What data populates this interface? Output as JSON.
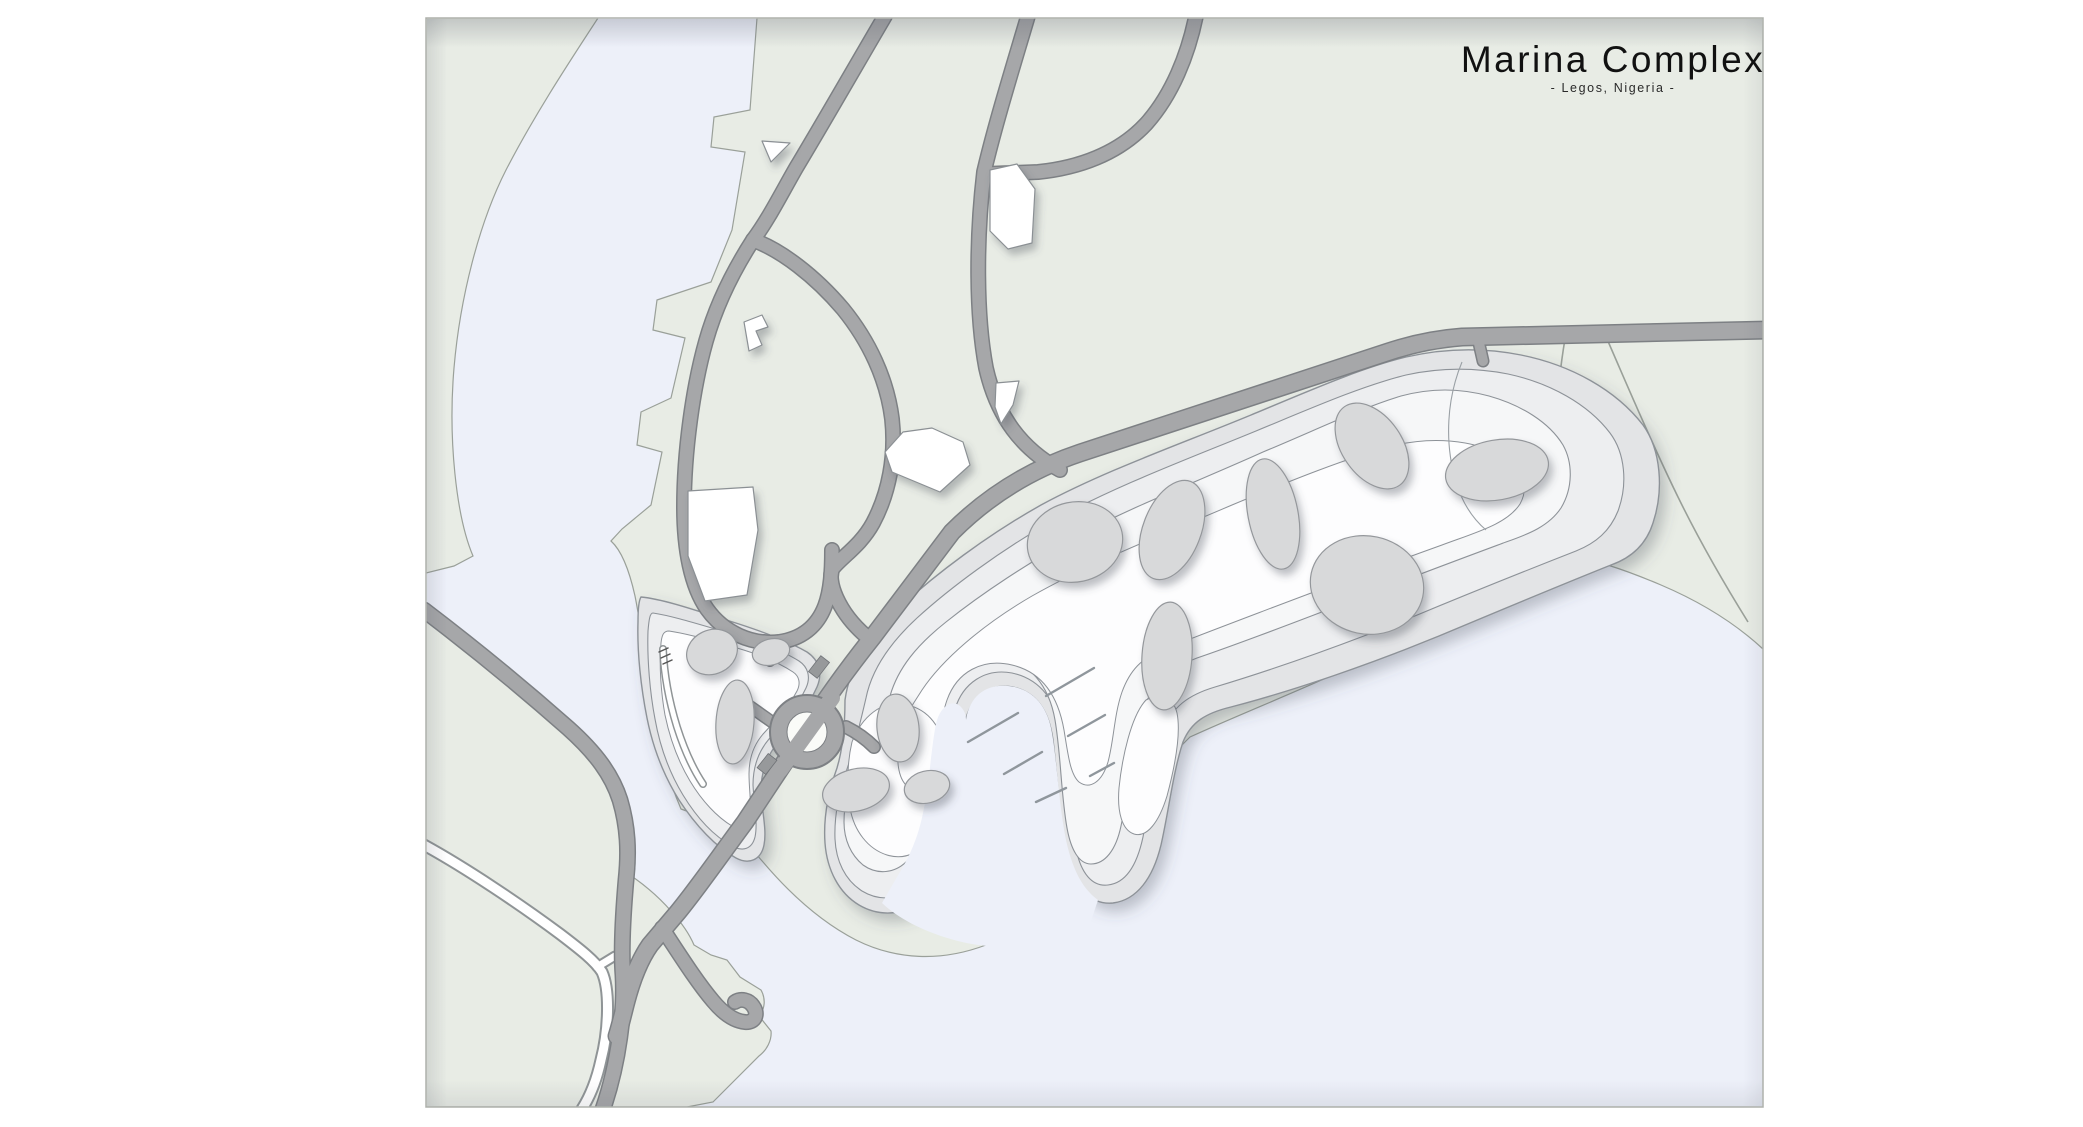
{
  "title": {
    "main": "Marina Complex",
    "subtitle": "- Legos, Nigeria -"
  },
  "colors": {
    "page_bg": "#ffffff",
    "water": "#edf0f9",
    "land": "#e8ece5",
    "land_stroke": "#9aa099",
    "road_fill": "#a6a7a9",
    "road_stroke": "#7d8084",
    "path_white": "#ffffff",
    "site_band_outer": "#e3e4e6",
    "site_band_mid": "#edeef0",
    "site_band_inner": "#f6f7f8",
    "site_band_core": "#fdfdfe",
    "contour_stroke": "#8d9298",
    "building_fill": "#d8d9da",
    "building_stroke": "#94979b",
    "structure_white": "#ffffff",
    "pier_stroke": "#8f969c",
    "border": "#adb0ab",
    "title_color": "#111111"
  },
  "features": {
    "water_bodies": [
      "river",
      "bay",
      "marina-basin"
    ],
    "piers_count": 6,
    "round_buildings_count": 13,
    "white_buildings_count": 4,
    "roundabout_count": 1,
    "sites": [
      "marina-main-site",
      "marina-west-site"
    ]
  }
}
